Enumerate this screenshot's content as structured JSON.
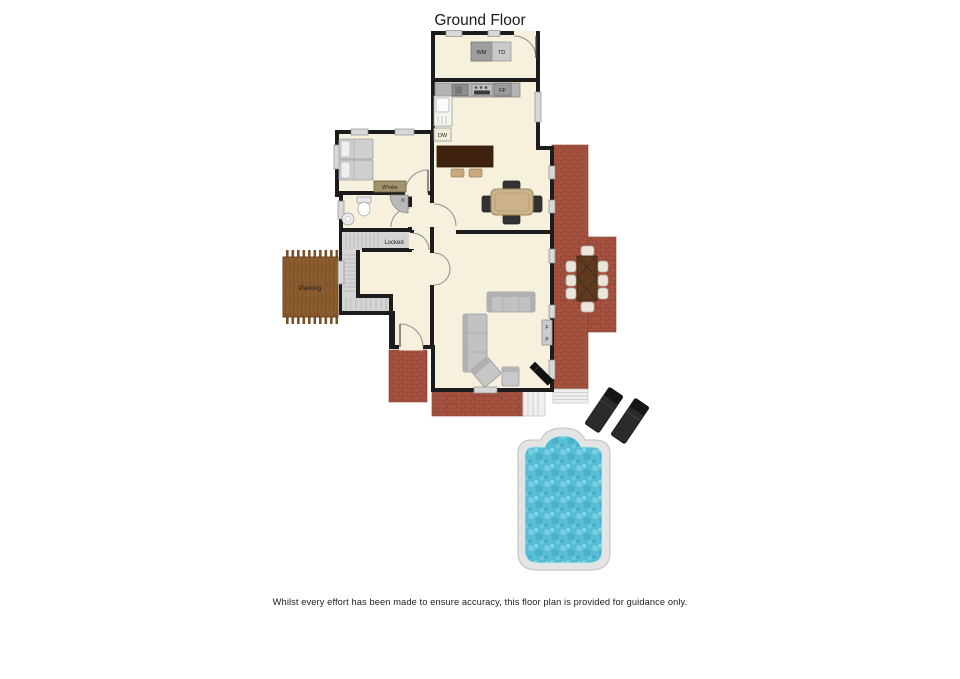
{
  "title": "Ground Floor",
  "disclaimer": "Whilst every effort has been made to ensure accuracy, this floor plan is provided for guidance only.",
  "labels": {
    "wm": "WM",
    "td": "TD",
    "ff": "FF",
    "dw": "DW",
    "wardrobe": "W'robe",
    "locked": "Locked",
    "parking": "Parking",
    "fireplace_f": "F",
    "fireplace_p": "P"
  },
  "colors": {
    "wall": "#1c1c1c",
    "floor": "#f7f0dd",
    "terrace_brick": "#a5513f",
    "deck_wood": "#8a5b2f",
    "pool_water": "#58bed5",
    "stairs_grey": "#d4d4d4"
  }
}
